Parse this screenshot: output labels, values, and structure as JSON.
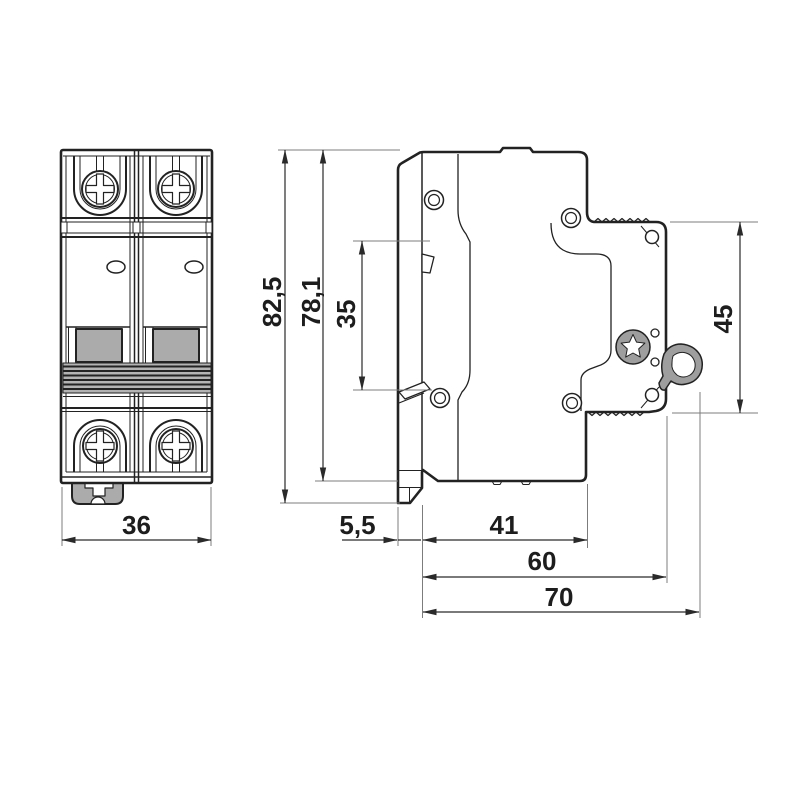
{
  "drawing": {
    "type": "technical-drawing",
    "subject": "2-pole modular circuit breaker, front and side views with dimensions",
    "colors": {
      "line": "#222222",
      "dimension_line": "#2a2a2a",
      "extension_line": "#7c7c7c",
      "gray_fill": "#ababab",
      "background": "#ffffff"
    },
    "views": {
      "front": {
        "width_mm": "36"
      },
      "side": {
        "total_height_mm": "82,5",
        "body_height_mm": "78,1",
        "din_slot_mm": "35",
        "front_section_mm": "45",
        "latch_protrusion_mm": "5,5",
        "rear_depth_mm": "41",
        "depth_to_bezel_mm": "60",
        "overall_depth_mm": "70"
      }
    }
  }
}
